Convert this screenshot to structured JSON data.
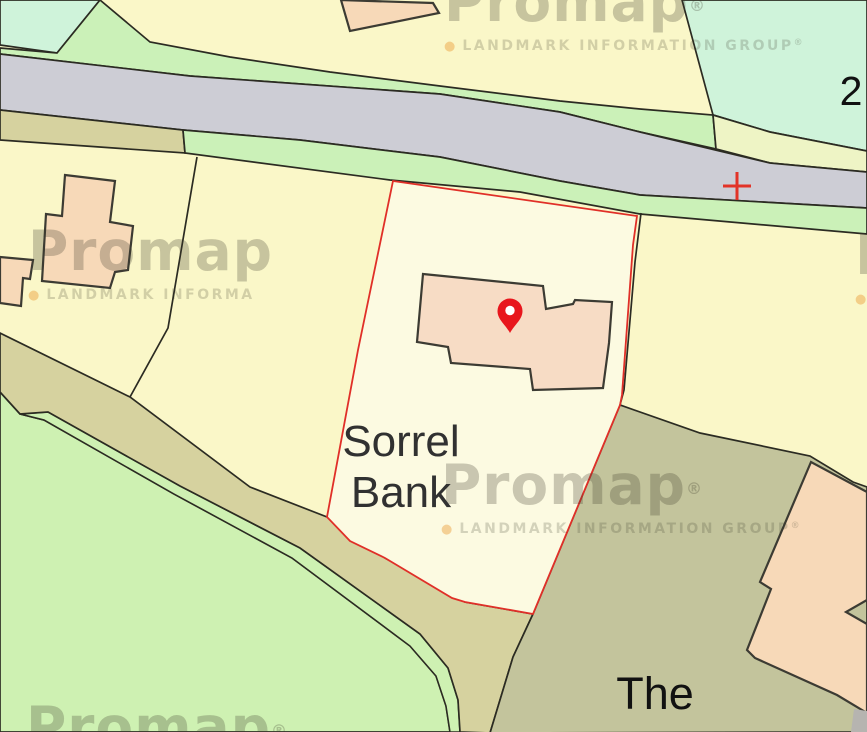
{
  "map": {
    "labels": {
      "property_name_line1": "Sorrel",
      "property_name_line2": "Bank",
      "neighbor_label": "The",
      "plot_number": "2"
    },
    "watermark": {
      "brand": "Promap",
      "registered_mark": "®",
      "bullet": "●",
      "tagline": "LANDMARK INFORMATION GROUP",
      "tagline_mark": "®",
      "tagline_truncated": "LANDMARK INFORMA"
    },
    "colors": {
      "boundary_red": "#E02F28",
      "pin_red": "#E8161D",
      "cross_red": "#E23328",
      "road_gray": "#CDCDD5",
      "verge_green": "#CBF1B8",
      "verge_yellow_green": "#EEF4C5",
      "mint_green": "#CFF3DA",
      "field_green": "#CEF1B2",
      "parcel_yellow": "#FAF7C8",
      "parcel_cream": "#FCFAE1",
      "track_olive": "#D6D29F",
      "parcel_olive": "#C3C49C",
      "building_peach": "#F7D9B8",
      "building_peach_light": "#F7DCC5"
    }
  }
}
